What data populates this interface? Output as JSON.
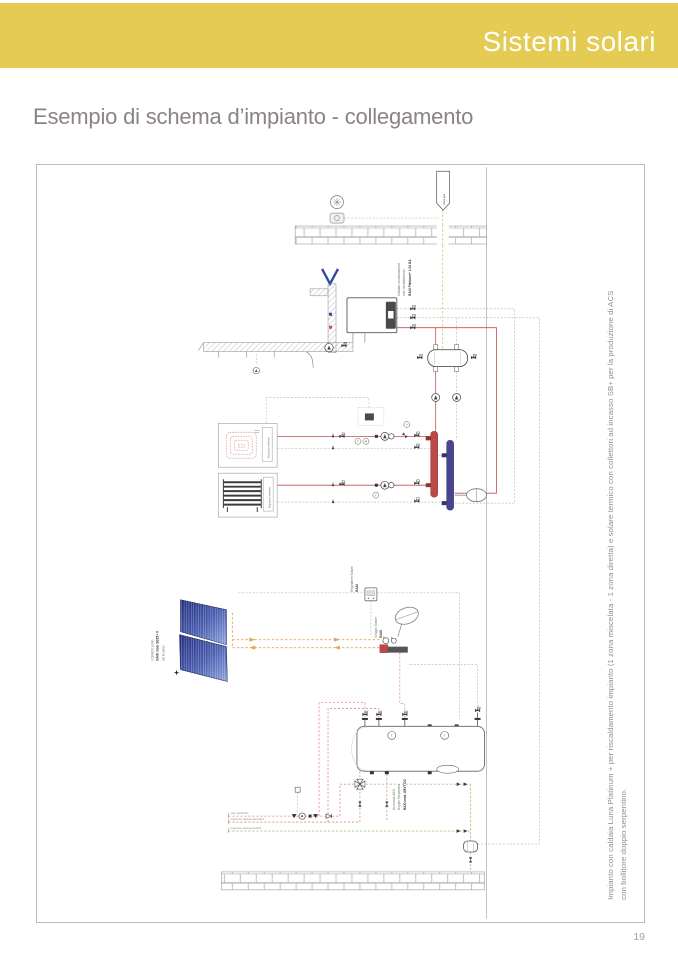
{
  "header": {
    "title": "Sistemi solari"
  },
  "page": {
    "title": "Esempio di schema d’impianto - collegamento",
    "number": "19"
  },
  "caption": {
    "line1": "Impianto con caldaia Luna Platinum + per riscaldamento impianto (1 zona miscelata - 1 zona diretta) e solare termico con collettori ad incasso SB+ per la produzione di ACS",
    "line2": "con bollitore doppio serpentino."
  },
  "diagram": {
    "gas_flag": "Linea gas",
    "boiler": {
      "l1": "Caldaia condensazione",
      "l2": "solo riscaldamento",
      "l3": "BAXI Platinum+ 1.24 GA"
    },
    "collector": {
      "l1": "Collettori solari",
      "l2": "BAXI mod. SB25+ V",
      "l3": "ad incasso"
    },
    "solar_controller": {
      "l1": "Regolatore Solare",
      "l2": "BAXI"
    },
    "solar_group": {
      "l1": "Gruppo Solare",
      "l2": "BAXI"
    },
    "tank": {
      "l1": "Accumulo ACS",
      "l2": "Doppio Serpentino",
      "l3": "BAXI mod. UBVT DC"
    },
    "room_regulator1": "Regolatore ambiente",
    "room_regulator2": "Regolatore ambiente",
    "water_lines": {
      "dhw": "Uso sanitario",
      "cold_in": "Ingresso acqua sanitaria",
      "cold_feed": "Ingresso acqua fredda"
    },
    "sensors": {
      "t": "T",
      "m": "M",
      "v": "V"
    }
  },
  "colors": {
    "accent": "#e3cb54",
    "title_text": "#8a8287",
    "pipe_hot": "#c0504d",
    "pipe_dhw": "#d98f8d",
    "pipe_cold": "#a8c97f",
    "pipe_solar": "#e2a74f",
    "pipe_gas": "#d8c878",
    "manifold_supply": "#b94a48",
    "manifold_return": "#4a4490",
    "collector_blue": "#3c4fa3"
  }
}
